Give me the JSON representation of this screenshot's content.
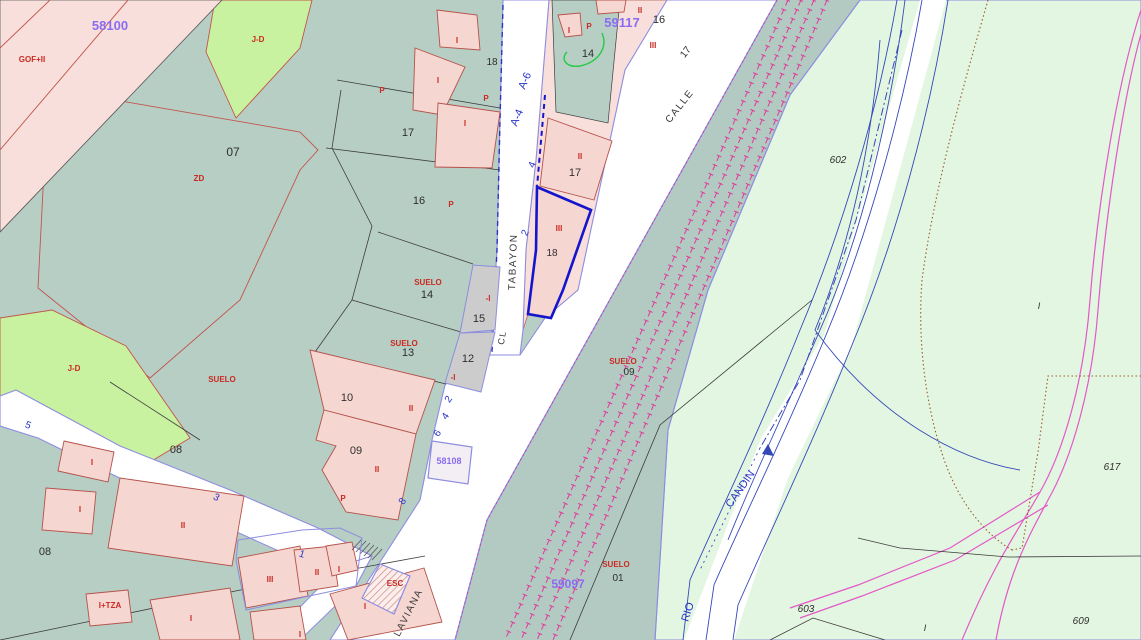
{
  "map": {
    "type": "cadastral-parcel-map",
    "selected_parcel": "18",
    "colors": {
      "urban_land": "#b7cec5",
      "railway_corridor": "#b2cac1",
      "rural_land": "#e3f6e1",
      "green_parcel": "#c8f2a0",
      "built_parcel_pink": "#f8dfdb",
      "building_fill": "#f6d6d1",
      "building_outline": "#b4524a",
      "gray_parcel": "#cccccc",
      "road_fill": "#ffffff",
      "road_edge_violet": "#8d8de0",
      "railway_magenta": "#e03a9a",
      "river_blue": "#3548b8",
      "path_pink": "#e358c8",
      "boundary_brown_dotted": "#9a5a30",
      "selection_blue": "#1515cc",
      "label_purple": "#8a6cf0",
      "label_red": "#c92a21",
      "label_blue": "#2a35c8",
      "green_line": "#22cc44"
    },
    "street_names": [
      "TABAYON",
      "CALLE",
      "LAVIANA",
      "RIO CANDIN"
    ],
    "sheet_numbers": [
      "58100",
      "59117",
      "59097",
      "58108"
    ],
    "labels": [
      {
        "t": "58100",
        "x": 110,
        "y": 30,
        "s": 13,
        "c": "purple"
      },
      {
        "t": "59117",
        "x": 622,
        "y": 27,
        "s": 13,
        "c": "purple"
      },
      {
        "t": "59097",
        "x": 568,
        "y": 588,
        "s": 12,
        "c": "purple"
      },
      {
        "t": "58108",
        "x": 449,
        "y": 464,
        "s": 9,
        "c": "purple"
      },
      {
        "t": "07",
        "x": 233,
        "y": 156,
        "s": 12,
        "c": "black"
      },
      {
        "t": "17",
        "x": 408,
        "y": 136,
        "c": "black"
      },
      {
        "t": "16",
        "x": 419,
        "y": 204,
        "c": "black"
      },
      {
        "t": "14",
        "x": 427,
        "y": 298,
        "c": "black"
      },
      {
        "t": "15",
        "x": 479,
        "y": 322,
        "c": "black"
      },
      {
        "t": "13",
        "x": 408,
        "y": 356,
        "c": "black"
      },
      {
        "t": "12",
        "x": 468,
        "y": 362,
        "c": "black"
      },
      {
        "t": "10",
        "x": 347,
        "y": 401,
        "c": "black"
      },
      {
        "t": "09",
        "x": 356,
        "y": 454,
        "c": "black"
      },
      {
        "t": "08",
        "x": 176,
        "y": 453,
        "c": "black"
      },
      {
        "t": "08",
        "x": 45,
        "y": 555,
        "c": "black"
      },
      {
        "t": "18",
        "x": 492,
        "y": 65,
        "s": 10,
        "c": "black"
      },
      {
        "t": "14",
        "x": 588,
        "y": 57,
        "c": "black"
      },
      {
        "t": "16",
        "x": 659,
        "y": 23,
        "c": "black"
      },
      {
        "t": "17",
        "x": 575,
        "y": 176,
        "c": "black"
      },
      {
        "t": "18",
        "x": 552,
        "y": 256,
        "s": 10,
        "c": "black"
      },
      {
        "t": "09",
        "x": 629,
        "y": 375,
        "s": 10,
        "c": "black"
      },
      {
        "t": "01",
        "x": 618,
        "y": 581,
        "s": 10,
        "c": "black"
      },
      {
        "t": "602",
        "x": 838,
        "y": 163,
        "s": 10,
        "c": "ital"
      },
      {
        "t": "603",
        "x": 806,
        "y": 612,
        "s": 10,
        "c": "ital"
      },
      {
        "t": "609",
        "x": 1081,
        "y": 624,
        "s": 10,
        "c": "ital"
      },
      {
        "t": "617",
        "x": 1112,
        "y": 470,
        "s": 10,
        "c": "ital"
      },
      {
        "t": "I",
        "x": 1039,
        "y": 309,
        "s": 9,
        "c": "ital"
      },
      {
        "t": "I",
        "x": 925,
        "y": 631,
        "s": 9,
        "c": "ital"
      },
      {
        "t": "TABAYON",
        "x": 516,
        "y": 262,
        "r": -88,
        "s": 10,
        "c": "street"
      },
      {
        "t": "CL",
        "x": 505,
        "y": 338,
        "r": -80,
        "s": 9,
        "c": "street"
      },
      {
        "t": "CALLE",
        "x": 682,
        "y": 108,
        "r": -52,
        "s": 10,
        "c": "street"
      },
      {
        "t": "17",
        "x": 688,
        "y": 54,
        "r": -52,
        "s": 10,
        "c": "black"
      },
      {
        "t": "LAVIANA",
        "x": 411,
        "y": 614,
        "r": -63,
        "s": 10,
        "c": "street"
      },
      {
        "t": "A-6",
        "x": 528,
        "y": 82,
        "r": -67,
        "s": 11,
        "c": "blue"
      },
      {
        "t": "A-4",
        "x": 520,
        "y": 119,
        "r": -67,
        "s": 11,
        "c": "blue"
      },
      {
        "t": "4",
        "x": 535,
        "y": 166,
        "r": -67,
        "s": 10,
        "c": "blue"
      },
      {
        "t": "2",
        "x": 528,
        "y": 234,
        "r": -67,
        "s": 10,
        "c": "blue"
      },
      {
        "t": "2",
        "x": 451,
        "y": 401,
        "r": -55,
        "s": 10,
        "c": "blue"
      },
      {
        "t": "4",
        "x": 448,
        "y": 418,
        "r": -55,
        "s": 10,
        "c": "blue"
      },
      {
        "t": "6",
        "x": 440,
        "y": 435,
        "r": -55,
        "s": 10,
        "c": "blue"
      },
      {
        "t": "8",
        "x": 405,
        "y": 503,
        "r": -55,
        "s": 10,
        "c": "blue"
      },
      {
        "t": "5",
        "x": 27,
        "y": 428,
        "r": 22,
        "s": 10,
        "c": "blue"
      },
      {
        "t": "3",
        "x": 215,
        "y": 500,
        "r": 28,
        "s": 10,
        "c": "blue"
      },
      {
        "t": "1",
        "x": 301,
        "y": 557,
        "r": 18,
        "s": 10,
        "c": "blue"
      },
      {
        "t": "RIO",
        "x": 691,
        "y": 613,
        "r": -72,
        "s": 11,
        "c": "blue"
      },
      {
        "t": "CANDIN",
        "x": 743,
        "y": 491,
        "r": -55,
        "s": 11,
        "c": "blue"
      },
      {
        "t": "GOF+II",
        "x": 32,
        "y": 62,
        "c": "red"
      },
      {
        "t": "J-D",
        "x": 258,
        "y": 42,
        "c": "red"
      },
      {
        "t": "J-D",
        "x": 74,
        "y": 371,
        "c": "red"
      },
      {
        "t": "ZD",
        "x": 199,
        "y": 181,
        "c": "red"
      },
      {
        "t": "SUELO",
        "x": 222,
        "y": 382,
        "c": "red"
      },
      {
        "t": "SUELO",
        "x": 428,
        "y": 285,
        "c": "red"
      },
      {
        "t": "SUELO",
        "x": 404,
        "y": 346,
        "c": "red"
      },
      {
        "t": "SUELO",
        "x": 623,
        "y": 364,
        "c": "red"
      },
      {
        "t": "SUELO",
        "x": 616,
        "y": 567,
        "c": "red"
      },
      {
        "t": "P",
        "x": 382,
        "y": 93,
        "c": "red"
      },
      {
        "t": "P",
        "x": 451,
        "y": 207,
        "c": "red"
      },
      {
        "t": "P",
        "x": 486,
        "y": 101,
        "c": "red"
      },
      {
        "t": "P",
        "x": 589,
        "y": 29,
        "c": "red"
      },
      {
        "t": "P",
        "x": 343,
        "y": 501,
        "c": "red"
      },
      {
        "t": "I",
        "x": 457,
        "y": 43,
        "c": "red"
      },
      {
        "t": "I",
        "x": 438,
        "y": 83,
        "c": "red"
      },
      {
        "t": "I",
        "x": 465,
        "y": 126,
        "c": "red"
      },
      {
        "t": "I",
        "x": 569,
        "y": 33,
        "c": "red"
      },
      {
        "t": "I",
        "x": 92,
        "y": 465,
        "c": "red"
      },
      {
        "t": "I",
        "x": 80,
        "y": 512,
        "c": "red"
      },
      {
        "t": "I",
        "x": 339,
        "y": 572,
        "c": "red"
      },
      {
        "t": "I",
        "x": 365,
        "y": 609,
        "c": "red"
      },
      {
        "t": "I",
        "x": 191,
        "y": 621,
        "c": "red"
      },
      {
        "t": "I",
        "x": 300,
        "y": 637,
        "c": "red"
      },
      {
        "t": "II",
        "x": 580,
        "y": 159,
        "c": "red"
      },
      {
        "t": "II",
        "x": 411,
        "y": 411,
        "c": "red"
      },
      {
        "t": "II",
        "x": 377,
        "y": 472,
        "c": "red"
      },
      {
        "t": "II",
        "x": 183,
        "y": 528,
        "c": "red"
      },
      {
        "t": "II",
        "x": 317,
        "y": 575,
        "c": "red"
      },
      {
        "t": "II",
        "x": 640,
        "y": 13,
        "c": "red"
      },
      {
        "t": "III",
        "x": 653,
        "y": 48,
        "c": "red"
      },
      {
        "t": "III",
        "x": 559,
        "y": 231,
        "c": "red"
      },
      {
        "t": "III",
        "x": 270,
        "y": 582,
        "c": "red"
      },
      {
        "t": "-I",
        "x": 488,
        "y": 301,
        "c": "red"
      },
      {
        "t": "-I",
        "x": 453,
        "y": 380,
        "c": "red"
      },
      {
        "t": "I+TZA",
        "x": 110,
        "y": 608,
        "c": "red"
      },
      {
        "t": "ESC",
        "x": 395,
        "y": 586,
        "c": "red"
      }
    ]
  }
}
